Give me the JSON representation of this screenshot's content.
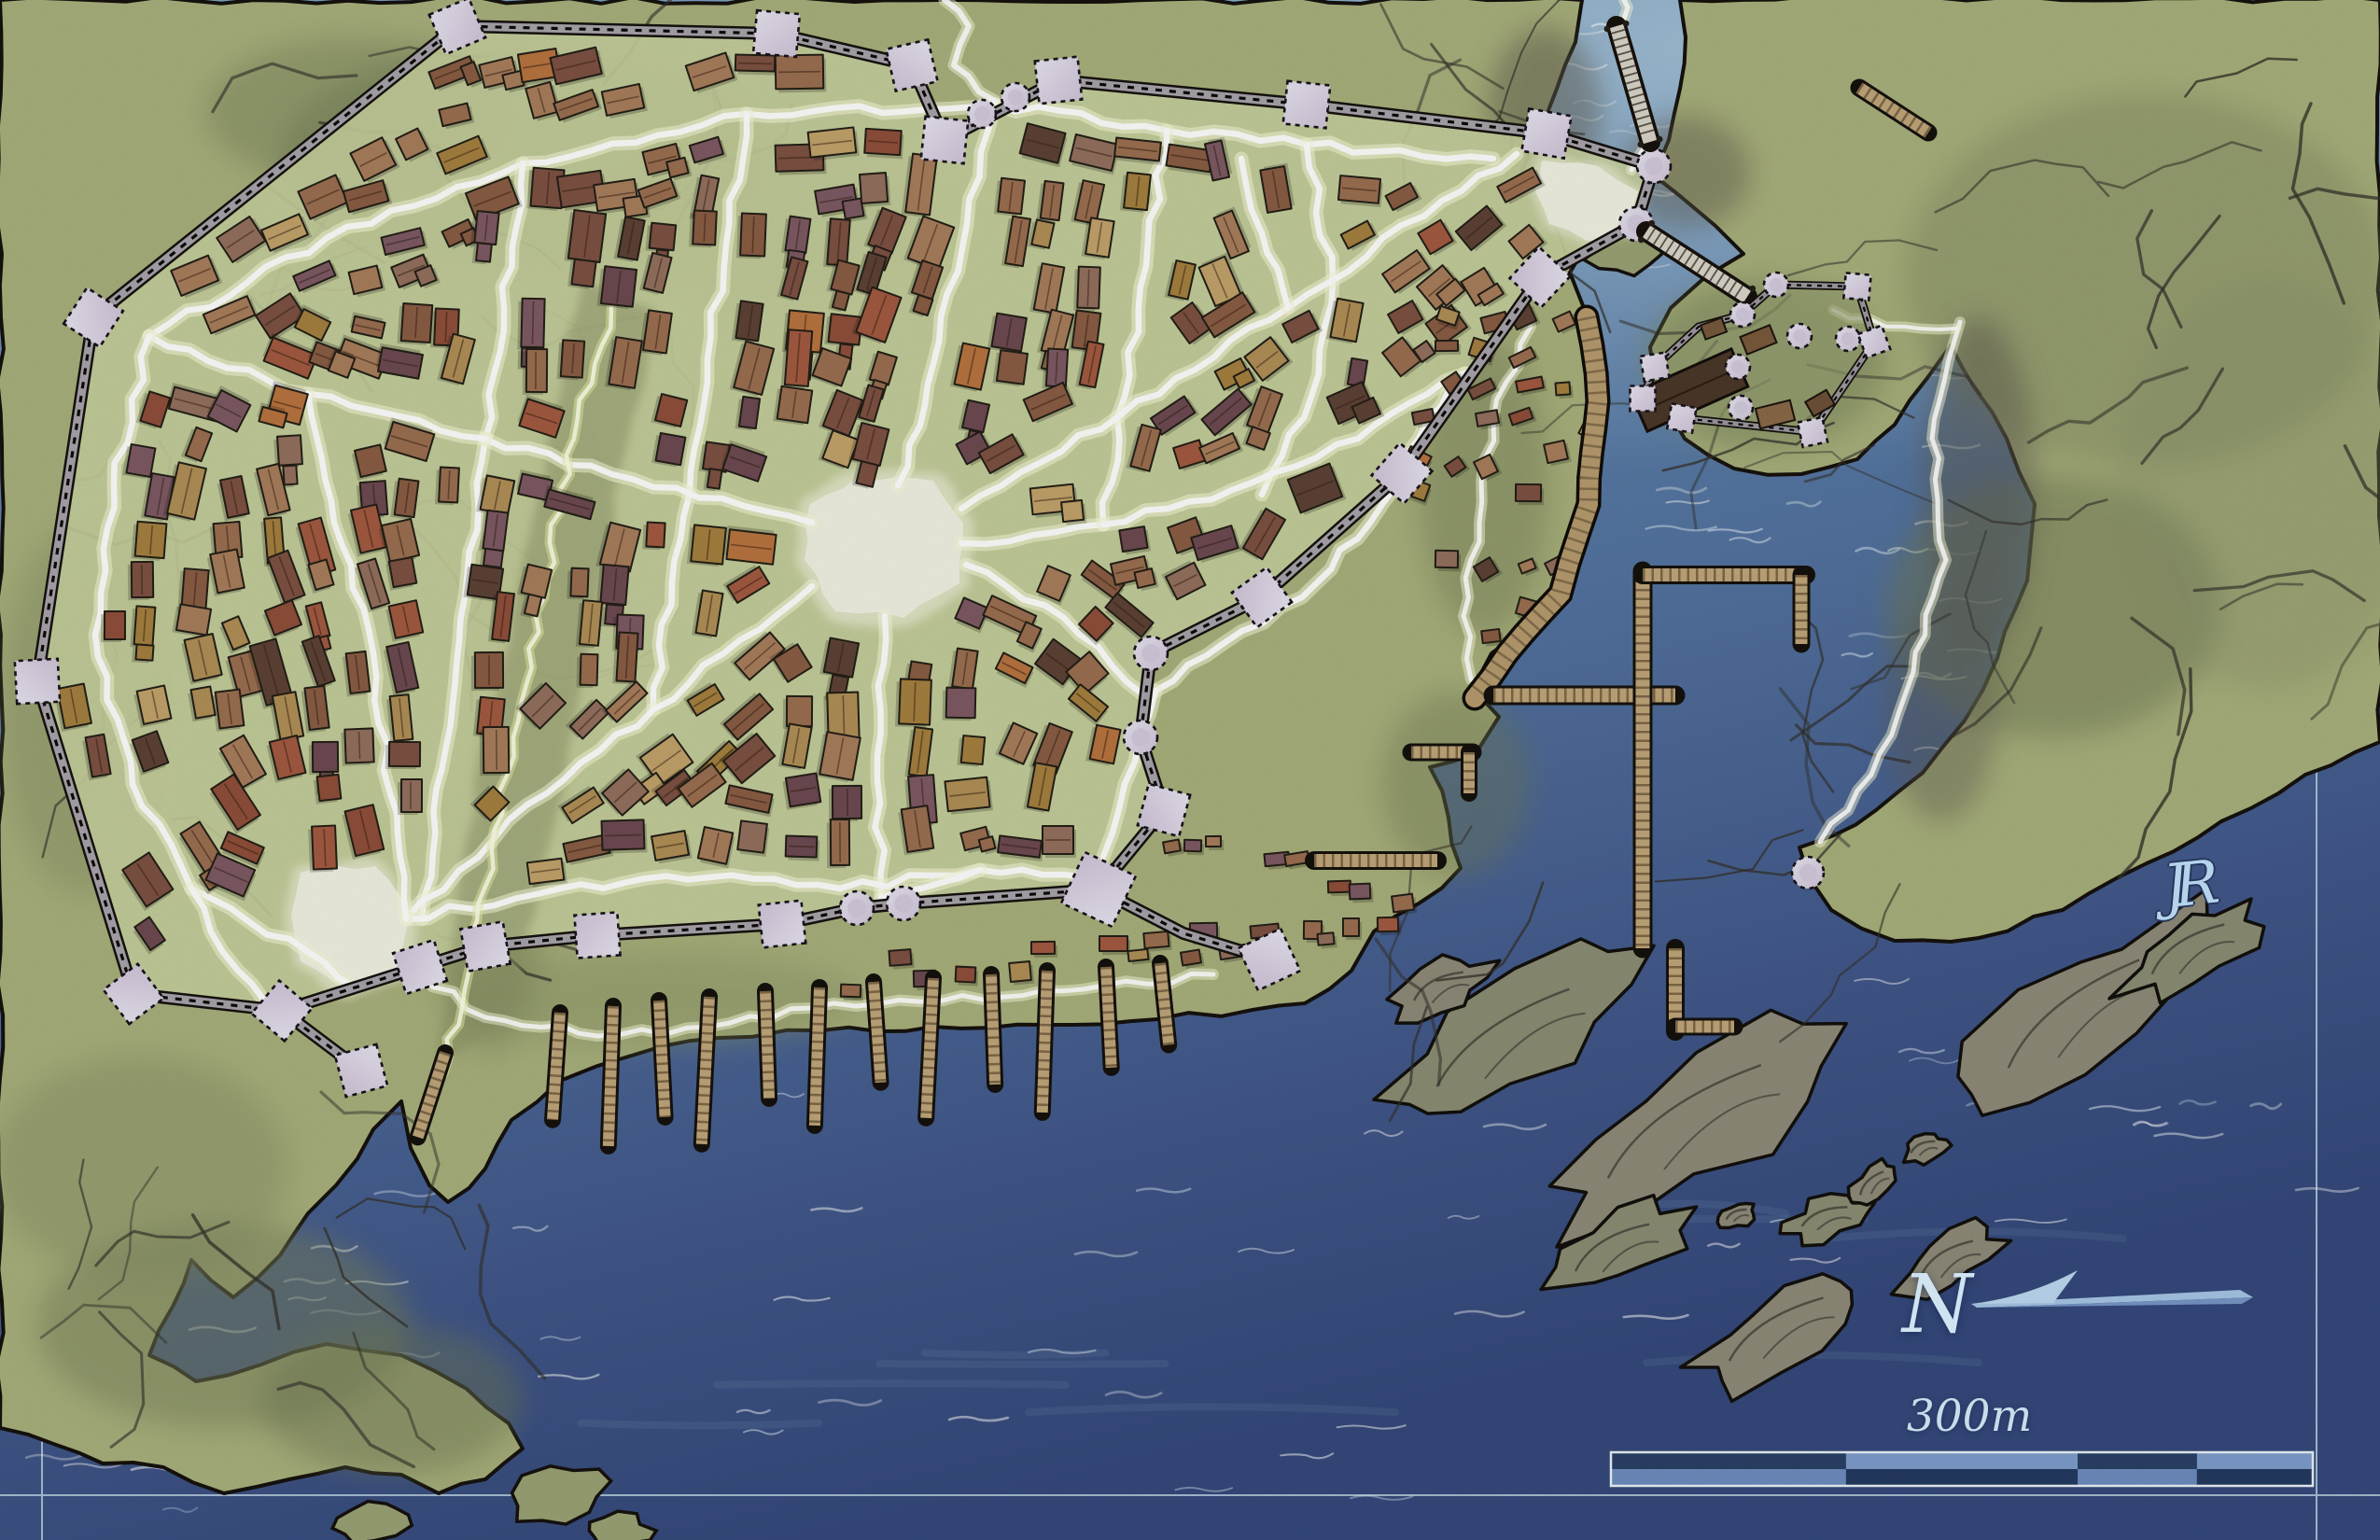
{
  "map": {
    "labels": {
      "compass_north": "N",
      "scale": "300m",
      "signature": "JR"
    },
    "features": [
      "walled-city",
      "city-wall-towers",
      "central-plaza",
      "northeast-gate-plaza",
      "southwest-plaza",
      "harbor-district",
      "curved-boardwalk",
      "harbor-piers",
      "south-shore-piers",
      "island-fortress",
      "north-bridge",
      "fortress-bridge",
      "river-estuary",
      "rocky-islands",
      "southwest-peninsula",
      "lone-watchtower",
      "compass-arrow",
      "scale-bar",
      "map-frame"
    ],
    "colors": {
      "water_light": "#82a5c3",
      "water_mid": "#53739f",
      "water_dark": "#35497b",
      "land": "#a9b07c",
      "land_shadow": "#6f7a55",
      "city_ground": "#c6ce9c",
      "street": "#ffffff",
      "street_glow": "#f7f9d8",
      "plaza": "#f2f2e3",
      "wall_band": "#a9a3ab",
      "wall_ink": "#16120d",
      "tower_fill": "#ded7e6",
      "tower_fill2": "#cfc5d8",
      "pier": "#c0a67a",
      "boardwalk": "#b79b6e",
      "rock_island": "#8f8b7a",
      "rock_dark": "#45423a",
      "bridge_deck": "#d9d5c9",
      "frame_line": "#b9d2e2",
      "label_text": "#cfe3f1",
      "arrow_fill": "#a6c6e6",
      "scale_dark": "#2a4066",
      "scale_light": "#7e9ccb",
      "scale_light2": "#6d8cbe",
      "scale_dark2": "#243a61",
      "scale_border": "#e9f2f6"
    },
    "scale_bar": {
      "segments_top": [
        "dark",
        "light",
        "dark",
        "light"
      ],
      "segments_bottom": [
        "light",
        "dark",
        "light",
        "dark"
      ],
      "fractions": [
        0,
        0.335,
        0.665,
        0.835,
        1
      ]
    },
    "generation": {
      "seed": 7,
      "building_grid": 46,
      "building_palette": [
        [
          "#9b6f50",
          16
        ],
        [
          "#8a5d44",
          13
        ],
        [
          "#a87e5c",
          11
        ],
        [
          "#7d5243",
          9
        ],
        [
          "#a35a40",
          7
        ],
        [
          "#8f4f3a",
          6
        ],
        [
          "#7e5a64",
          8
        ],
        [
          "#6d4a52",
          5
        ],
        [
          "#b08f57",
          8
        ],
        [
          "#a5813f",
          5
        ],
        [
          "#c2a36a",
          4
        ],
        [
          "#5e4336",
          4
        ],
        [
          "#94705e",
          7
        ],
        [
          "#b8743f",
          3
        ]
      ]
    }
  }
}
